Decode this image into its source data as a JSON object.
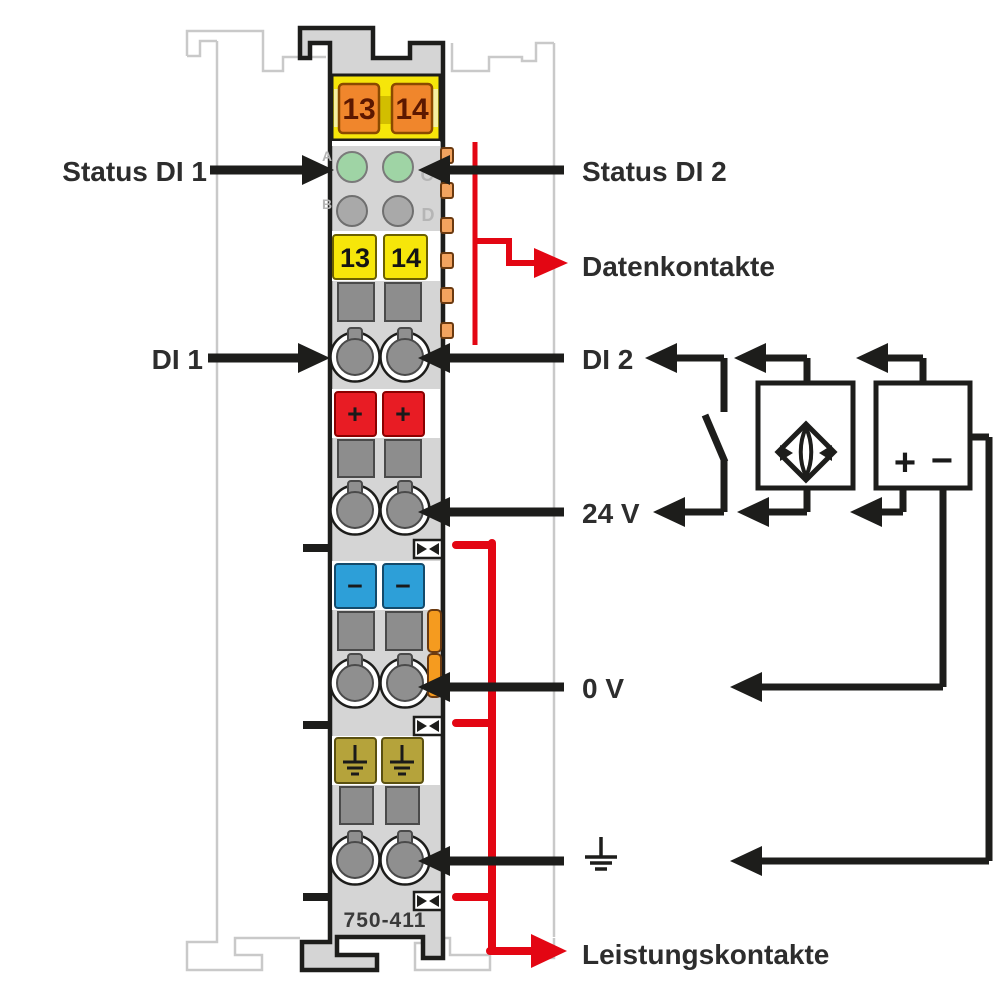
{
  "labels": {
    "status_di1": "Status DI 1",
    "status_di2": "Status DI 2",
    "datenkontakte": "Datenkontakte",
    "di1": "DI 1",
    "di2": "DI 2",
    "v24": "24 V",
    "v0": "0 V",
    "leistungskontakte": "Leistungskontakte"
  },
  "module": {
    "part_number": "750-411",
    "top_terminals": [
      "13",
      "14"
    ],
    "mid_terminals": [
      "13",
      "14"
    ],
    "led_letters": [
      "A",
      "B",
      "C",
      "D"
    ],
    "plus": "+",
    "minus": "−"
  },
  "psu": {
    "plus": "+",
    "minus": "−"
  },
  "colors": {
    "red_accent": "#e30613",
    "module_yellow": "#f6e60a",
    "terminal_orange": "#f0862c",
    "led_green": "#9fd4a5",
    "terminal_red": "#e81c24",
    "terminal_blue": "#2d9fd8",
    "terminal_olive": "#b5a33b",
    "body_gray": "#d5d5d5",
    "line_black": "#1d1d1b",
    "ghost_gray": "#c9c9c9"
  }
}
